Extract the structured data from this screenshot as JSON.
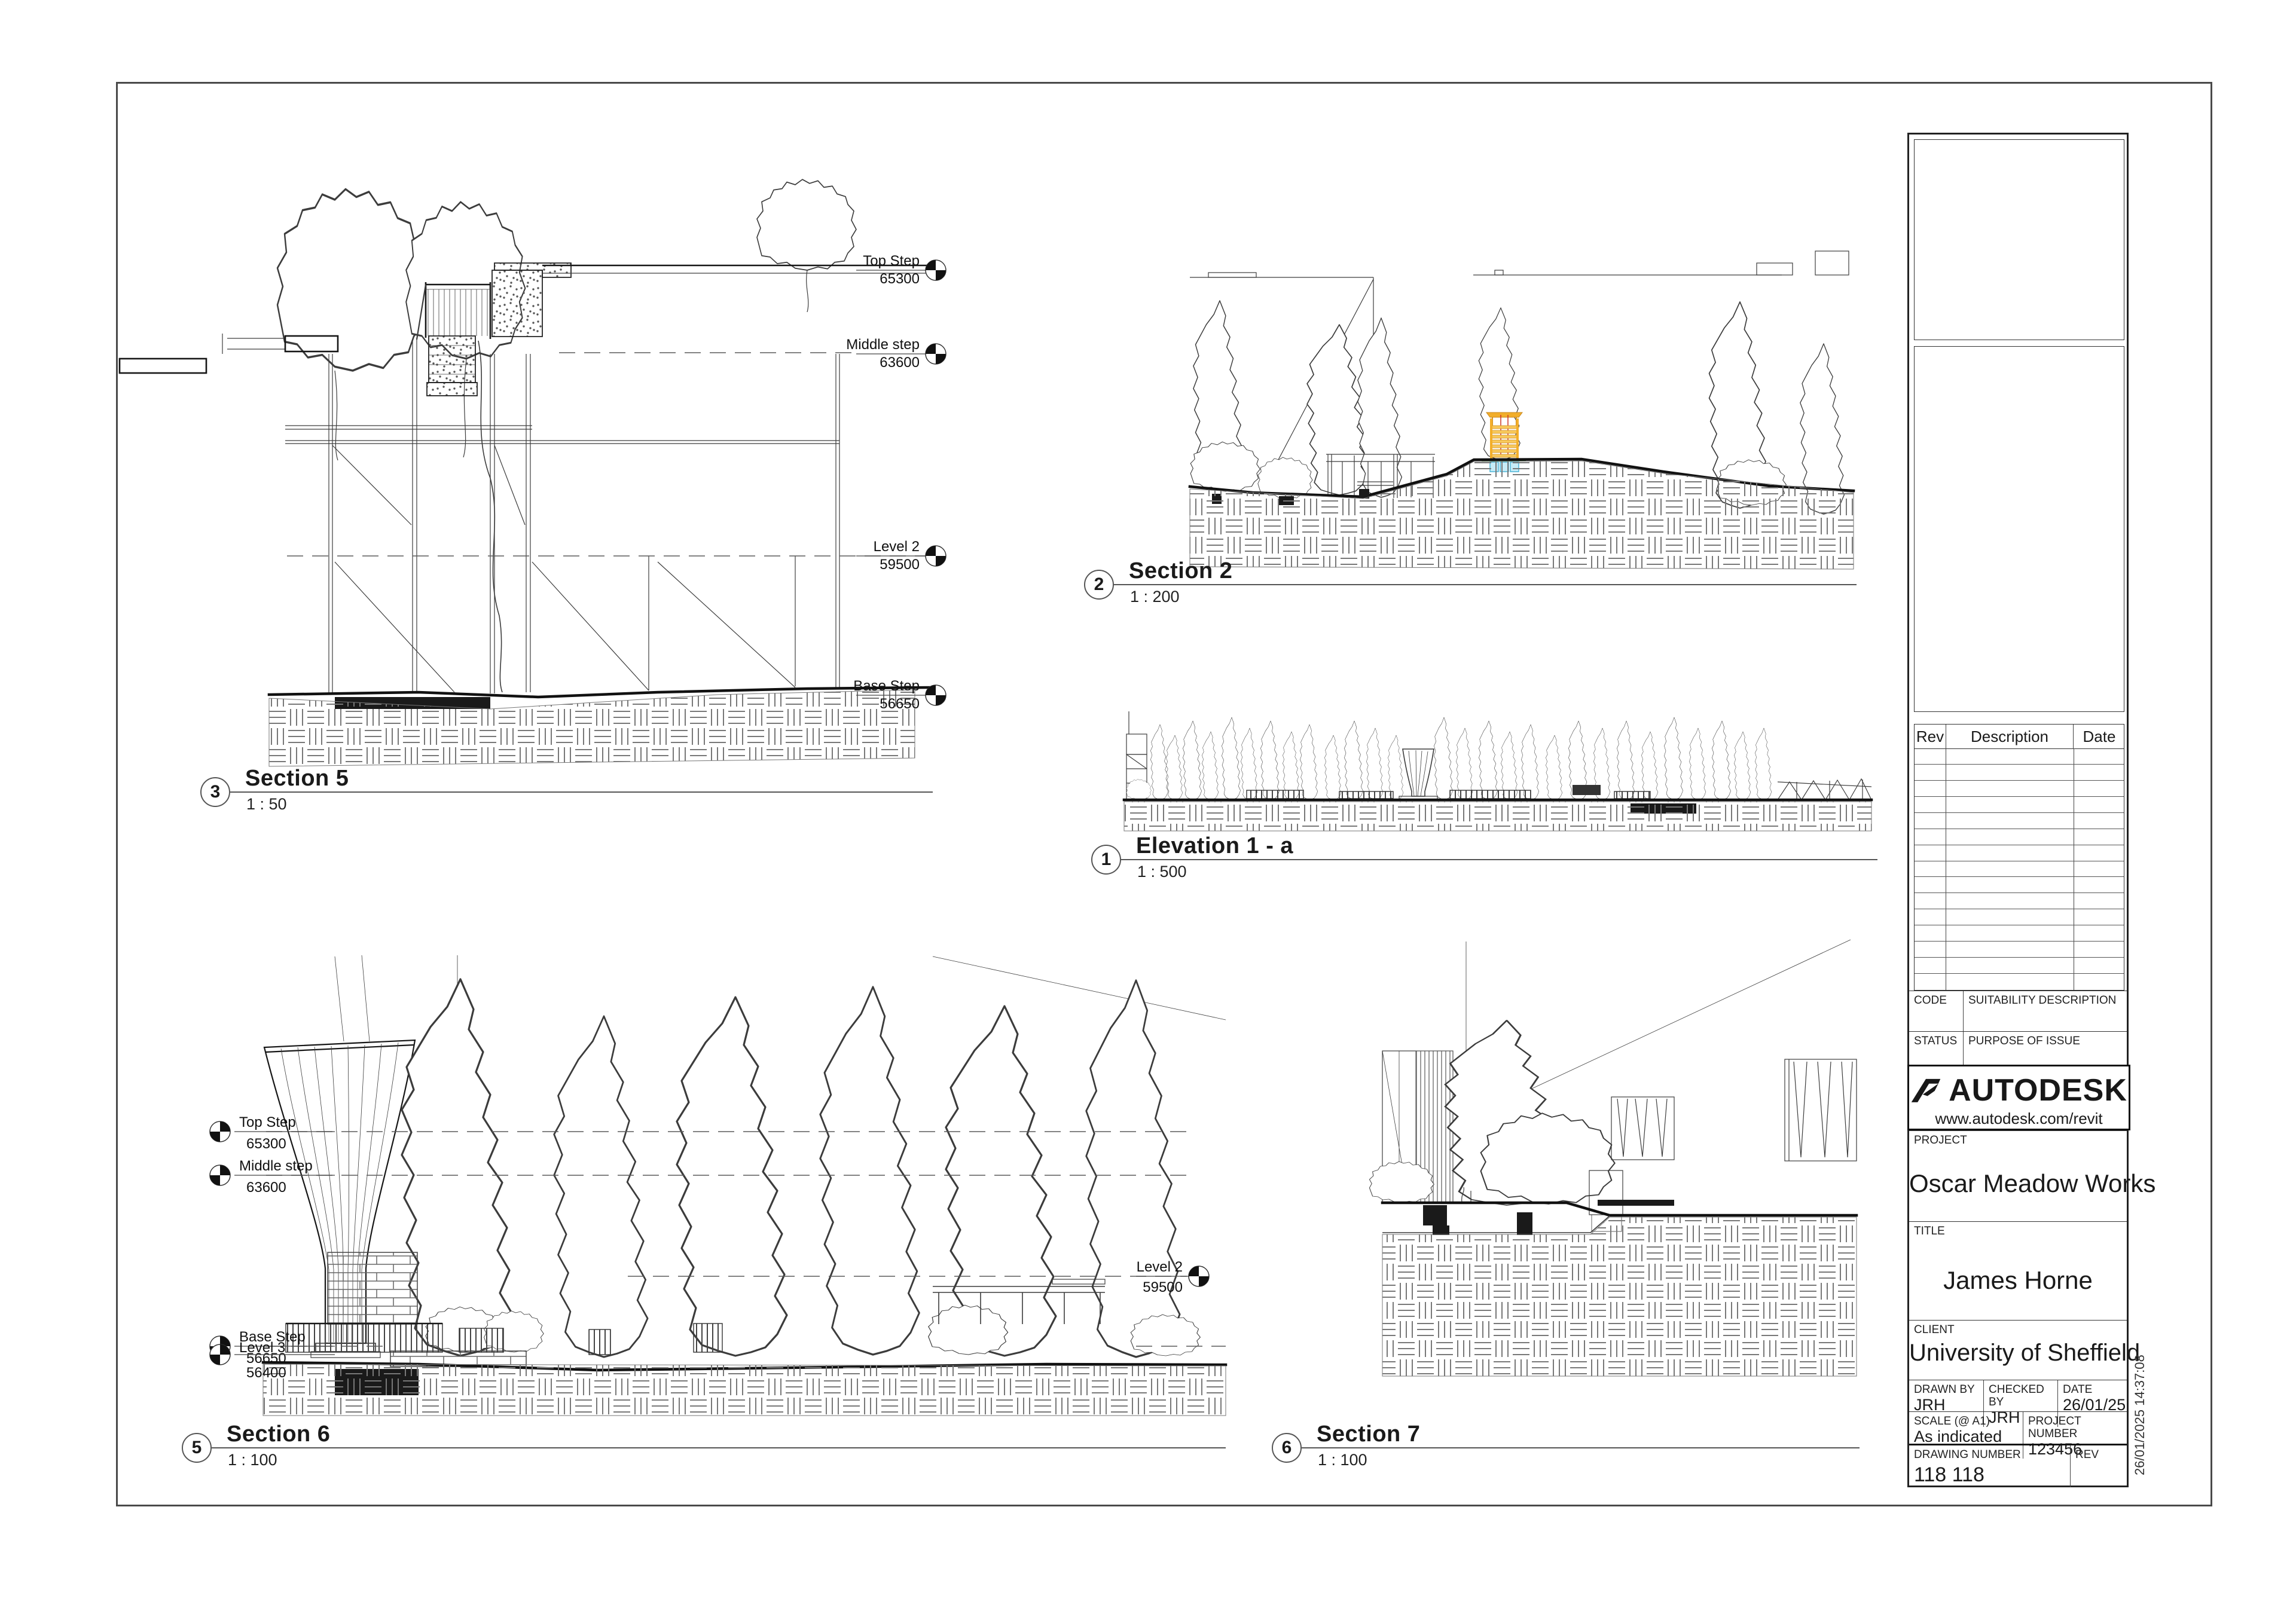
{
  "sheet": {
    "timestamp": "26/01/2025 14:37:08"
  },
  "views": [
    {
      "number": "3",
      "title": "Section 5",
      "scale": "1 : 50"
    },
    {
      "number": "2",
      "title": "Section 2",
      "scale": "1 : 200"
    },
    {
      "number": "1",
      "title": "Elevation 1 - a",
      "scale": "1 : 500"
    },
    {
      "number": "5",
      "title": "Section 6",
      "scale": "1 : 100"
    },
    {
      "number": "6",
      "title": "Section 7",
      "scale": "1 : 100"
    }
  ],
  "levels": {
    "top_step": {
      "label": "Top Step",
      "value": "65300"
    },
    "middle_step": {
      "label": "Middle step",
      "value": "63600"
    },
    "level2": {
      "label": "Level 2",
      "value": "59500"
    },
    "base_step": {
      "label": "Base Step",
      "value": "56650"
    },
    "level3": {
      "label": "Level 3",
      "value": "56400"
    }
  },
  "map": {
    "labels": [
      "DN",
      "DN",
      "DN"
    ]
  },
  "colors": {
    "tower_yellow": "#f2ae2a",
    "tower_yellow_light": "#f8c95c",
    "tower_stroke": "#d19020",
    "foundation_cyan": "#c7ecf7",
    "foundation_cyan_stroke": "#4ab4d6",
    "accent_green": "#3f8f2f",
    "accent_red": "#cc3322"
  },
  "titleblock": {
    "rev_table": {
      "headers": [
        "Rev",
        "Description",
        "Date"
      ]
    },
    "code": {
      "label": "CODE"
    },
    "suitability": {
      "label": "SUITABILITY DESCRIPTION"
    },
    "status": {
      "label": "STATUS"
    },
    "purpose": {
      "label": "PURPOSE OF ISSUE"
    },
    "brand": {
      "name": "AUTODESK",
      "url": "www.autodesk.com/revit"
    },
    "project": {
      "label": "PROJECT",
      "value": "Oscar Meadow Works"
    },
    "title": {
      "label": "TITLE",
      "value": "James Horne"
    },
    "client": {
      "label": "CLIENT",
      "value": "University of Sheffield"
    },
    "drawn_by": {
      "label": "DRAWN BY",
      "value": "JRH"
    },
    "checked_by": {
      "label": "CHECKED BY",
      "value": "JRH"
    },
    "date": {
      "label": "DATE",
      "value": "26/01/25"
    },
    "scale": {
      "label": "SCALE (@ A1)",
      "value": "As indicated"
    },
    "project_number": {
      "label": "PROJECT NUMBER",
      "value": "123456"
    },
    "drawing_number": {
      "label": "DRAWING NUMBER",
      "value": "118 118"
    },
    "rev": {
      "label": "REV"
    }
  }
}
